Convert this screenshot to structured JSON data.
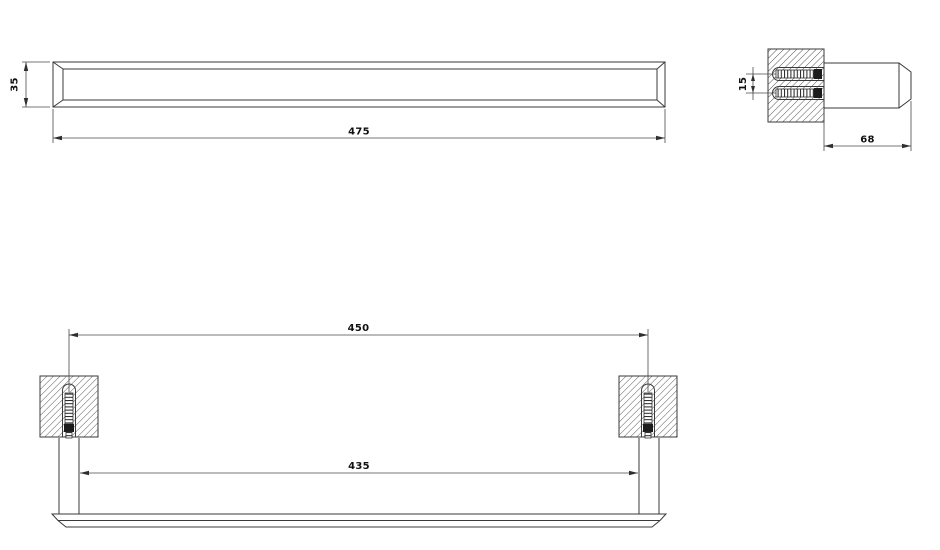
{
  "colors": {
    "line": "#3a3a3a",
    "text": "#111111",
    "hatch": "#4a4a4a",
    "background": "#ffffff"
  },
  "front_view": {
    "length_label": "475",
    "height_label": "35"
  },
  "side_view": {
    "depth_label": "68",
    "screw_spacing_label": "15"
  },
  "plan_view": {
    "centers_label": "450",
    "span_label": "435"
  }
}
